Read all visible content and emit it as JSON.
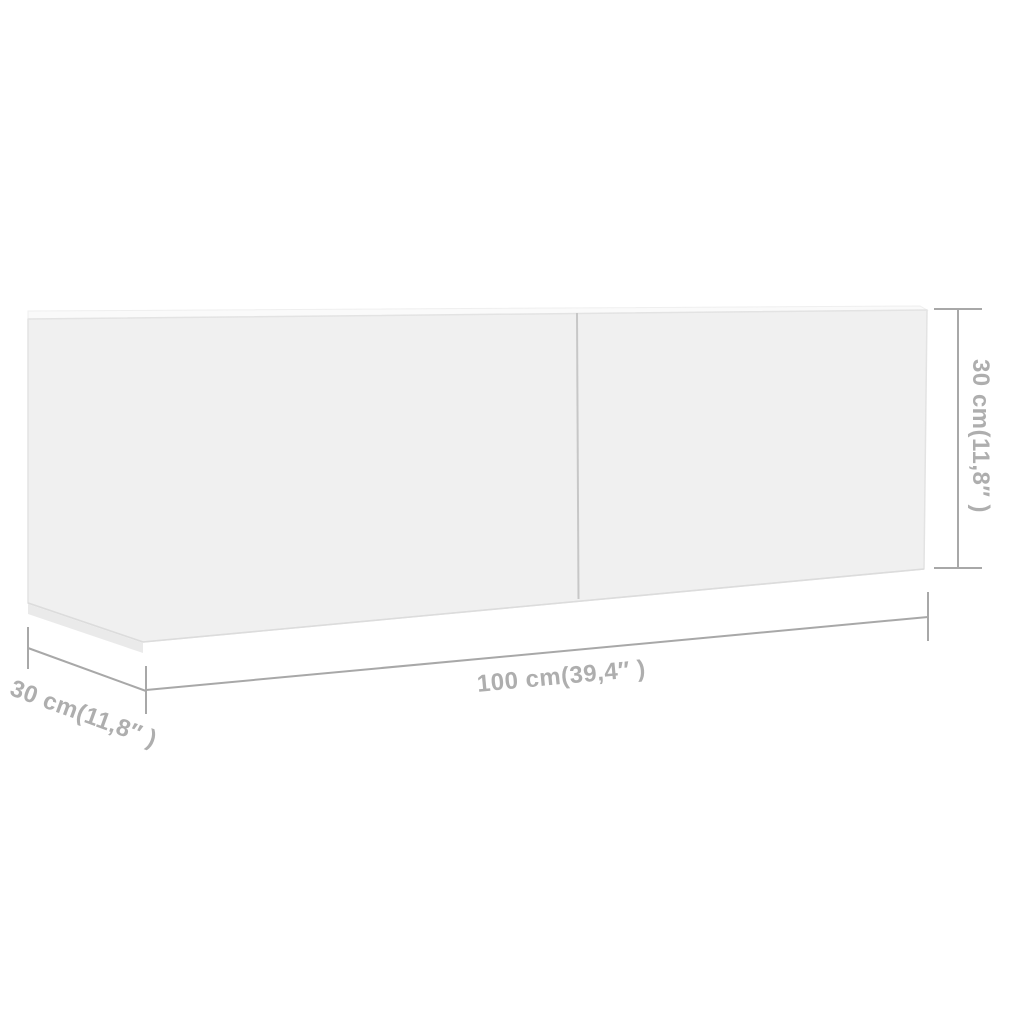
{
  "diagram": {
    "title": "TV cabinet dimension diagram",
    "product": "wall-mounted TV cabinet, white, two doors",
    "labels": {
      "width": "100 cm(39,4″ )",
      "height": "30 cm(11,8″ )",
      "depth": "30 cm(11,8″ )"
    },
    "dimensions_cm": {
      "width": 100,
      "height": 30,
      "depth": 30
    },
    "colors": {
      "background": "#ffffff",
      "cabinet_face": "#f0f0f0",
      "cabinet_face_edge": "#e3e3e3",
      "cabinet_bottom_edge": "#dcdcdc",
      "cabinet_bottom_strip": "#eaeaea",
      "cabinet_top_sliver": "#fafafa",
      "door_divider": "#c7c7c7",
      "dimension_line": "#a8a8a8",
      "dimension_text": "#aeaeae"
    }
  }
}
